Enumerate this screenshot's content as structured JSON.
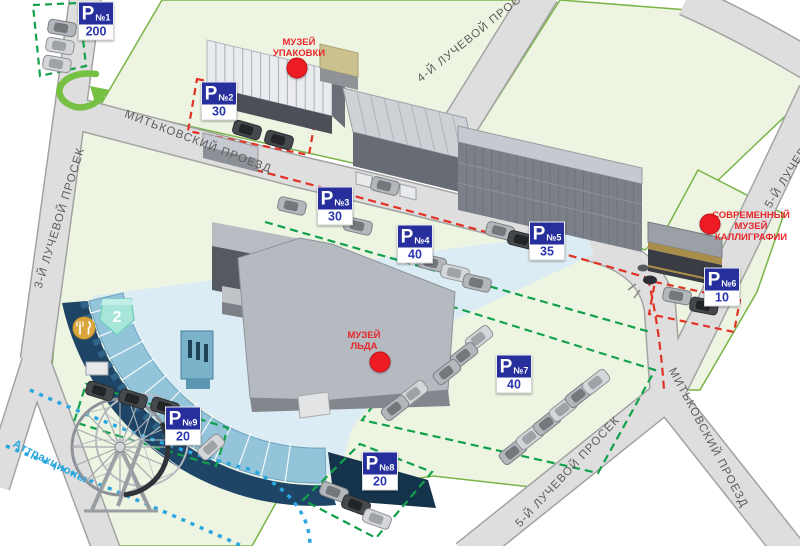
{
  "map": {
    "attractions_label": "Аттракционы",
    "zone_badge": "2",
    "parking_letter": "P"
  },
  "streets": [
    {
      "name": "МИТЬКОВСКИЙ ПРОЕЗД"
    },
    {
      "name": "3-Й ЛУЧЕВОЙ ПРОСЕК"
    },
    {
      "name": "4-Й ЛУЧЕВОЙ ПРОСЕК"
    },
    {
      "name": "5-Й ЛУЧЕВОЙ ПРОСЕК"
    },
    {
      "name": "5-Й ЛУЧЕВОЙ ПРОСЕК"
    },
    {
      "name": "МИТЬКОВСКИЙ ПРОЕЗД"
    }
  ],
  "museums": [
    {
      "name": "МУЗЕЙ УПАКОВКИ",
      "lines": [
        "МУЗЕЙ",
        "УПАКОВКИ"
      ]
    },
    {
      "name": "МУЗЕЙ ЛЬДА",
      "lines": [
        "МУЗЕЙ",
        "ЛЬДА"
      ]
    },
    {
      "name": "СОВРЕМЕННЫЙ МУЗЕЙ КАЛЛИГРАФИИ",
      "lines": [
        "СОВРЕМЕННЫЙ",
        "МУЗЕЙ",
        "КАЛЛИГРАФИИ"
      ]
    }
  ],
  "parkings": [
    {
      "number": "№1",
      "capacity": "200"
    },
    {
      "number": "№2",
      "capacity": "30"
    },
    {
      "number": "№3",
      "capacity": "30"
    },
    {
      "number": "№4",
      "capacity": "40"
    },
    {
      "number": "№5",
      "capacity": "35"
    },
    {
      "number": "№6",
      "capacity": "10"
    },
    {
      "number": "№7",
      "capacity": "40"
    },
    {
      "number": "№8",
      "capacity": "20"
    },
    {
      "number": "№9",
      "capacity": "20"
    }
  ],
  "colors": {
    "parking_sign_blue": "#262f9b",
    "museum_label_red": "#e8262a",
    "attractions_blue": "#2aa7df",
    "zone_green_dash": "#12a14b",
    "zone_red_dash": "#e23125",
    "park_green": "#edf5e2",
    "road_gray": "#dedede",
    "marker_red": "#ed1c24"
  }
}
